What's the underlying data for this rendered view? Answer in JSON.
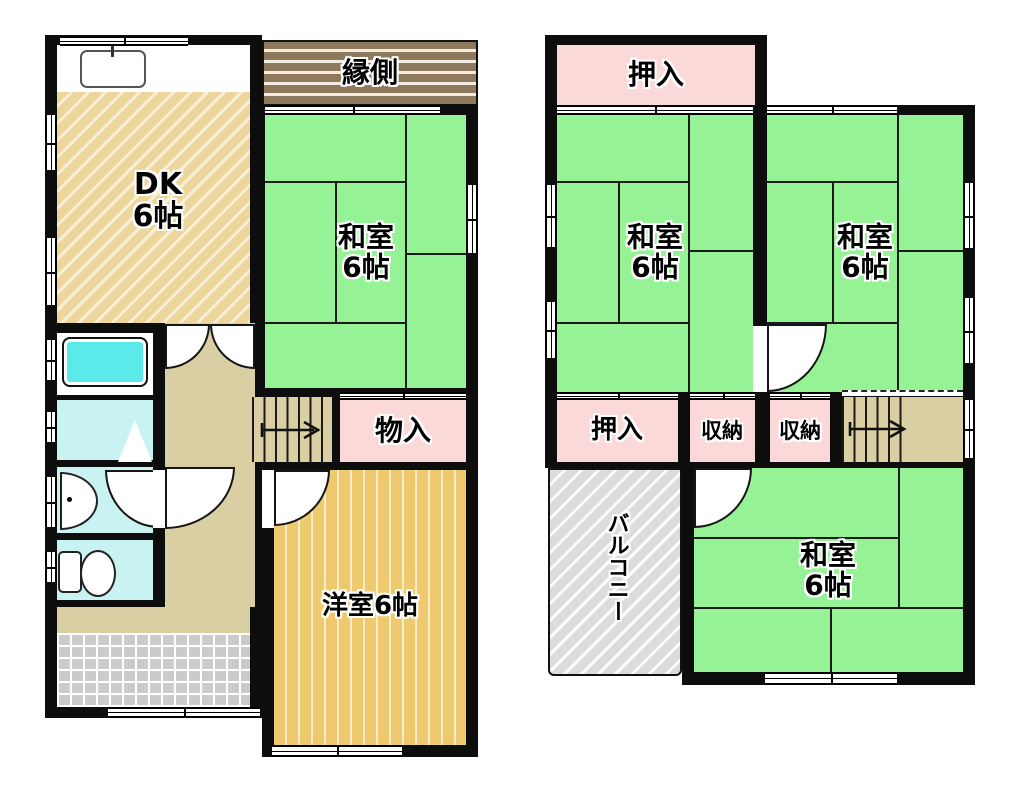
{
  "colors": {
    "wall": "#0d0d0d",
    "tatami": "#95f295",
    "pink": "#fbd9d9",
    "dk": "#edd69c",
    "dkline": "#f8efd6",
    "western": "#efc96e",
    "engawa": "#8e795c",
    "hall": "#d9cfa3",
    "bath": "#5ce9e9",
    "wet": "#c9f3f3",
    "balcony": "#dcdcdc",
    "tile": "#cbcbcb"
  },
  "floor1": {
    "engawa_label": "縁側",
    "dk": {
      "name": "DK",
      "size": "6帖"
    },
    "washitsu": {
      "name": "和室",
      "size": "6帖"
    },
    "monoiri_label": "物入",
    "yoshitsu_label": "洋室6帖"
  },
  "floor2": {
    "oshiire_top_label": "押入",
    "washitsu_left": {
      "name": "和室",
      "size": "6帖"
    },
    "washitsu_right": {
      "name": "和室",
      "size": "6帖"
    },
    "oshiire_label": "押入",
    "shuno_a_label": "収納",
    "shuno_b_label": "収納",
    "balcony_label": "バルコニー",
    "washitsu_bottom": {
      "name": "和室",
      "size": "6帖"
    }
  }
}
